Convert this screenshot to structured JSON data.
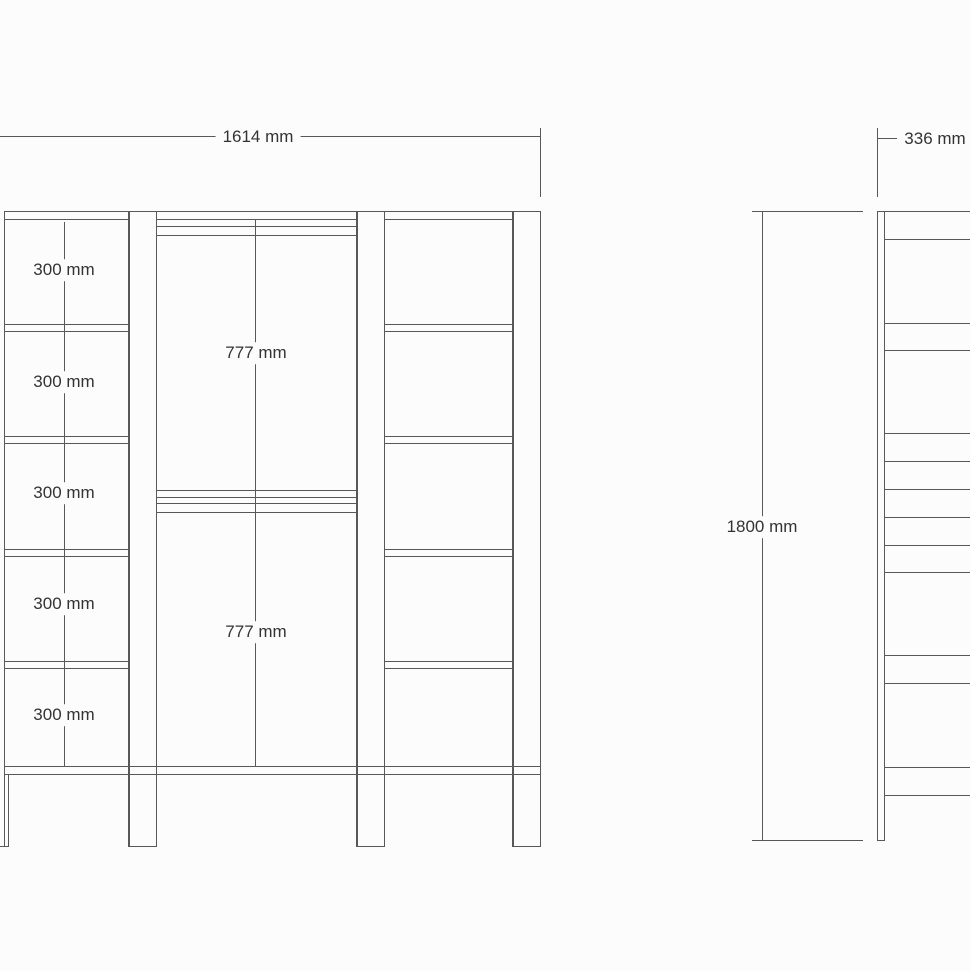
{
  "page": {
    "background": "#fcfcfc",
    "line_color": "#585858",
    "text_color": "#333333"
  },
  "front_view": {
    "title": "wardrobe front elevation",
    "width_dimension": "1614 mm",
    "shelf_dimensions": [
      "300 mm",
      "300 mm",
      "300 mm",
      "300 mm",
      "300 mm"
    ],
    "door_dimensions": [
      "777 mm",
      "777 mm"
    ]
  },
  "side_view": {
    "title": "wardrobe side elevation",
    "depth_dimension": "336 mm",
    "height_dimension": "1800 mm"
  }
}
